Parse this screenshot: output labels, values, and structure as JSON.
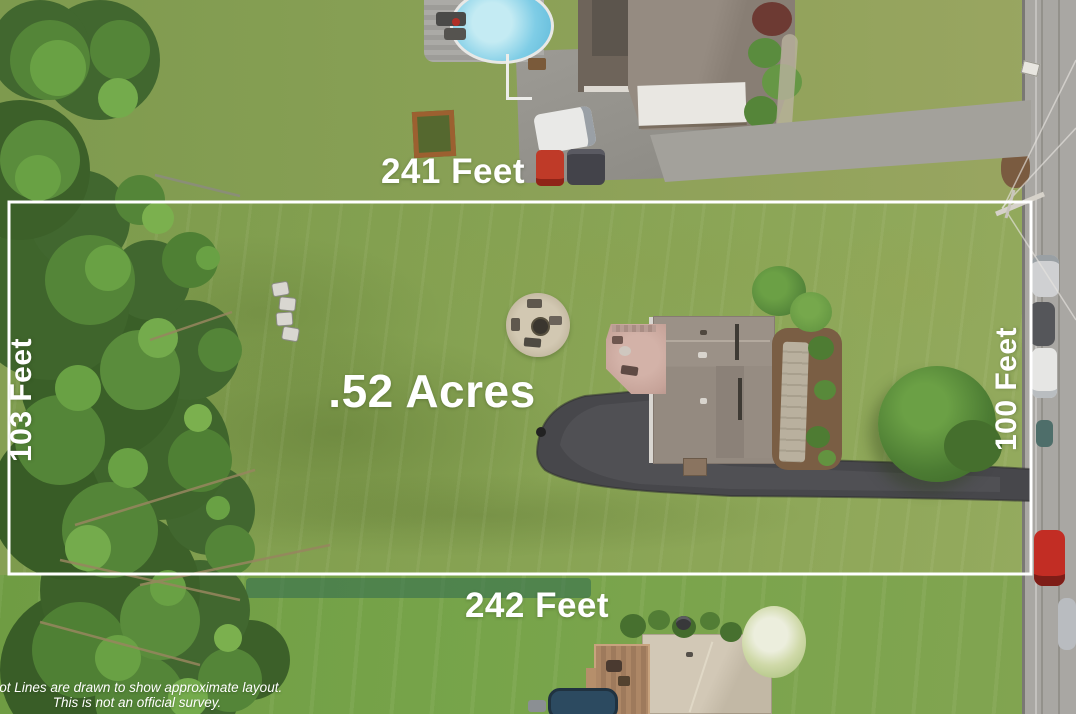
{
  "scene_type": "aerial-lot-photo",
  "labels": {
    "top": "241 Feet",
    "bottom": "242 Feet",
    "left": "103 Feet",
    "right": "100 Feet",
    "area": ".52 Acres"
  },
  "disclaimer": {
    "line1": "Lot Lines are drawn to show approximate layout.",
    "line2": "This is not an official survey."
  },
  "palette": {
    "lot_line": "#ffffff",
    "label_text": "#ffffff",
    "lawn": "#86a054",
    "lawn_bottom": "#74a046",
    "forest_dark": "#41672f",
    "forest_mid": "#548538",
    "forest_light": "#69a144",
    "road": "#a9a7a3",
    "asphalt_driveway": "#47474b",
    "concrete_driveway": "#9a9892",
    "main_house_roof": "#958b81",
    "neighbor_house_roof": "#8d8379",
    "bottom_house_roof": "#cfc5b3",
    "deck_pink": "#c7a49a",
    "wood_deck": "#a8815f",
    "pool_water": "#7fcde6",
    "stone_patio": "#c9bfa8",
    "red_car": "#c22d24",
    "mulch": "#7a5e44"
  }
}
